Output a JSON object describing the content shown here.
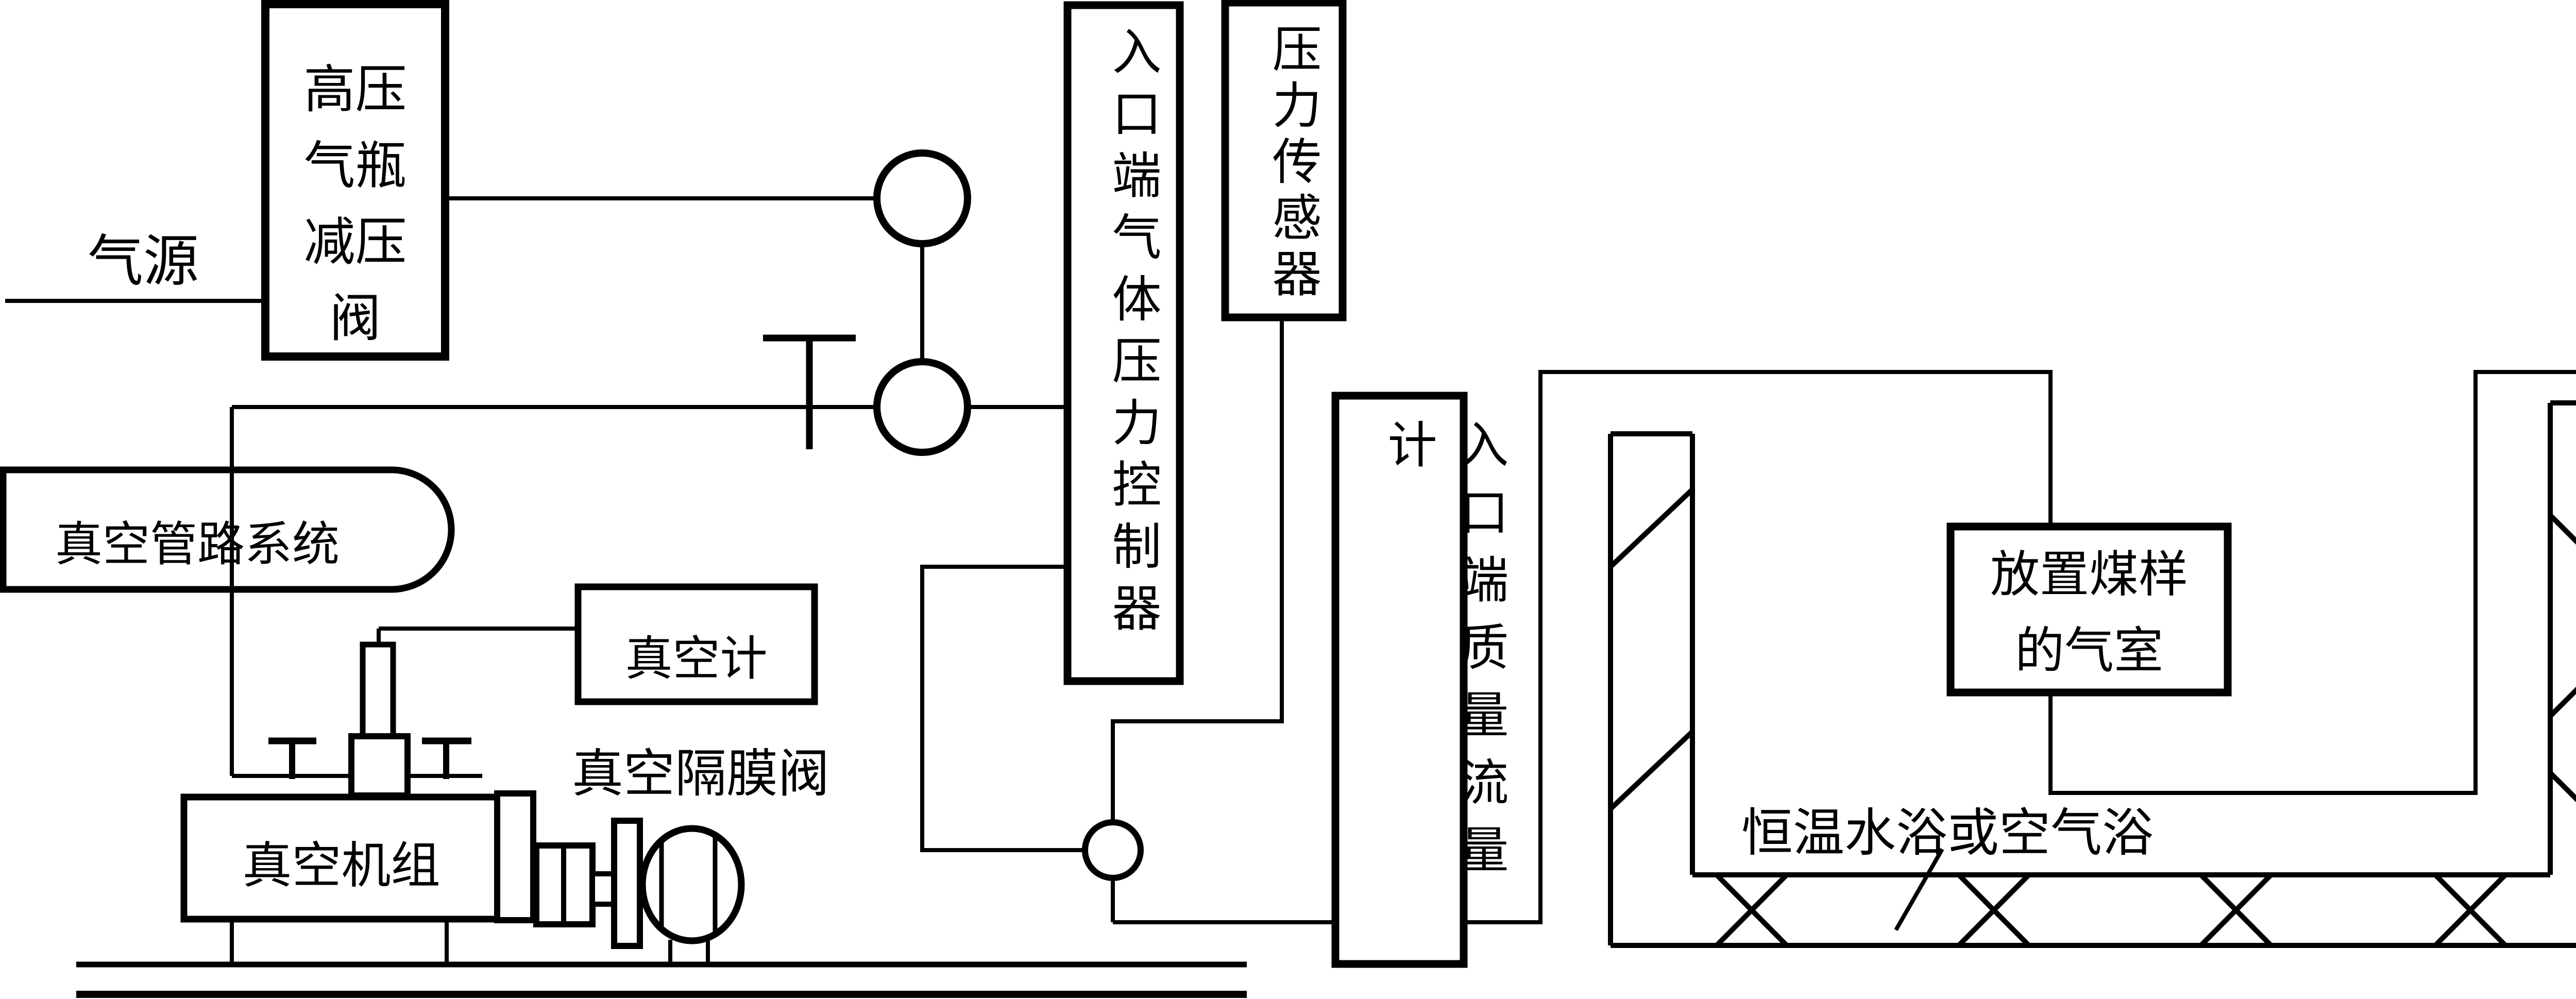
{
  "colors": {
    "line": "#000000",
    "background": "#ffffff"
  },
  "labels": {
    "gas_source": "气源",
    "hp_cylinder_regulator_lines": [
      "高压",
      "气瓶",
      "减压",
      "阀"
    ],
    "vacuum_line_system": "真空管路系统",
    "vacuum_gauge": "真空计",
    "vacuum_diaphragm_valve": "真空隔膜阀",
    "vacuum_pump_unit": "真空机组",
    "inlet_gas_pressure_controller": "入口端气体压力控制器",
    "inlet_pressure_sensor": "压力传感器",
    "inlet_mass_flow_meter": "入口端质量流量计",
    "coal_sample_chamber_lines": [
      "放置煤样",
      "的气室"
    ],
    "thermostat_bath": "恒温水浴或空气浴",
    "outlet_mass_flow_meter": "出口端质量流量计",
    "outlet_pressure_sensor": "压力传感器",
    "outlet_gas_pressure_controller": "出口端气体压力控制器"
  }
}
